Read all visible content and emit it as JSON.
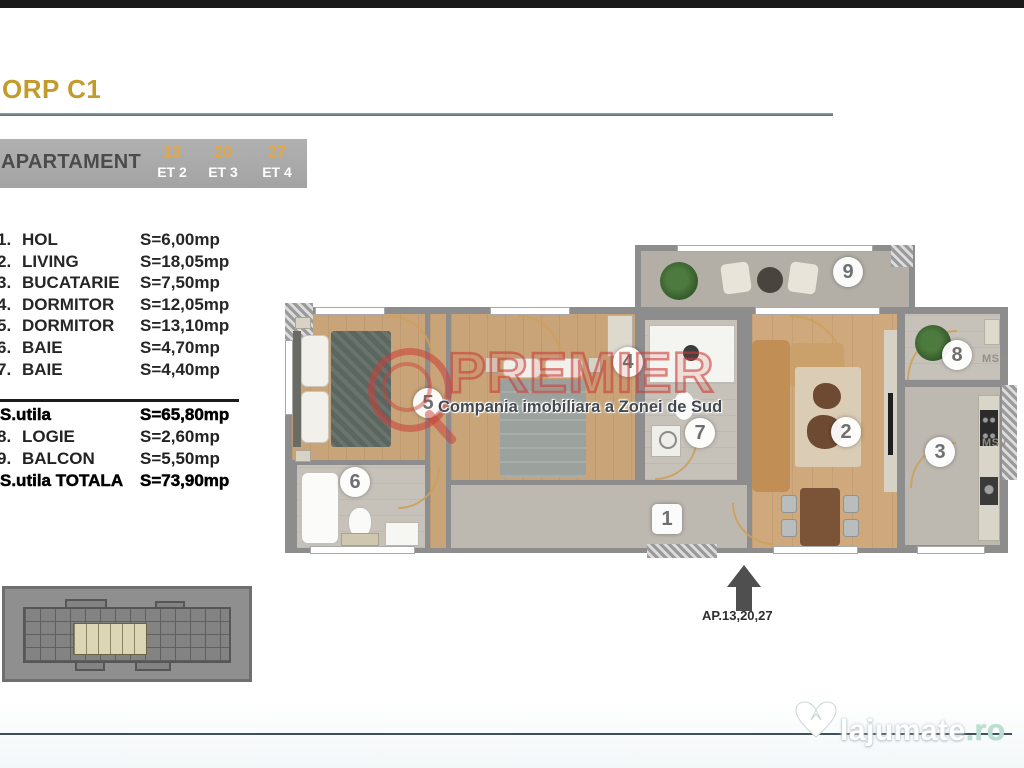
{
  "page": {
    "title": "ORP C1"
  },
  "apartment_table": {
    "label": "APARTAMENT",
    "units": [
      {
        "number": "13",
        "floor": "ET 2"
      },
      {
        "number": "20",
        "floor": "ET 3"
      },
      {
        "number": "27",
        "floor": "ET 4"
      }
    ]
  },
  "rooms": [
    {
      "index": "1.",
      "name": "HOL",
      "area": "S=6,00mp"
    },
    {
      "index": "2.",
      "name": "LIVING",
      "area": "S=18,05mp"
    },
    {
      "index": "3.",
      "name": "BUCATARIE",
      "area": "S=7,50mp"
    },
    {
      "index": "4.",
      "name": "DORMITOR",
      "area": "S=12,05mp"
    },
    {
      "index": "5.",
      "name": "DORMITOR",
      "area": "S=13,10mp"
    },
    {
      "index": "6.",
      "name": "BAIE",
      "area": "S=4,70mp"
    },
    {
      "index": "7.",
      "name": "BAIE",
      "area": "S=4,40mp"
    }
  ],
  "totals": [
    {
      "index": "",
      "label": "S.utila",
      "area": "S=65,80mp"
    },
    {
      "index": "8.",
      "label": "LOGIE",
      "area": "S=2,60mp"
    },
    {
      "index": "9.",
      "label": "BALCON",
      "area": "S=5,50mp"
    },
    {
      "index": "",
      "label": "S.utila TOTALA",
      "area": "S=73,90mp"
    }
  ],
  "plan": {
    "badges": {
      "hol": "1",
      "living": "2",
      "bucatarie": "3",
      "dormitor_mid": "4",
      "dormitor_left": "5",
      "baie_left": "6",
      "baie_mid": "7",
      "logie": "8",
      "balcon": "9"
    },
    "msr": "MSR",
    "msv": "MSV",
    "arrow_label": "AP.13,20,27"
  },
  "watermarks": {
    "premier": {
      "name": "PREMIER",
      "tagline": "Compania imobiliara a Zonei de Sud"
    },
    "site": {
      "name": "lajumate",
      "tld": ".ro"
    }
  },
  "colors": {
    "title_gold": "#c39b2b",
    "unit_orange": "#e7a73e",
    "premier_red": "#ca3e38",
    "site_teal": "#b9dfd2",
    "wall_gray": "#8d8d8d"
  }
}
